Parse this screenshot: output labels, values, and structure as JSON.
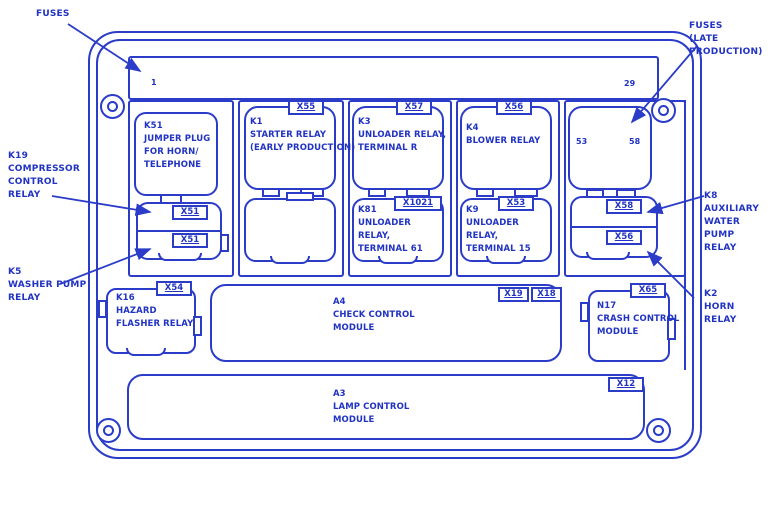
{
  "colors": {
    "line": "#2a3cc8",
    "text": "#2133c2",
    "background": "#ffffff"
  },
  "callouts": {
    "fuses": "FUSES",
    "fuses_late": "FUSES\n(LATE\nPRODUCTION)",
    "k19": "K19\nCOMPRESSOR\nCONTROL\nRELAY",
    "k5": "K5\nWASHER PUMP\nRELAY",
    "k8": "K8\nAUXILIARY\nWATER PUMP\nRELAY",
    "k2": "K2\nHORN RELAY"
  },
  "fuse_strip": {
    "first_fuse": "1",
    "last_fuse": "29"
  },
  "relays": {
    "k51": {
      "text": "K51\nJUMPER PLUG\nFOR HORN/\nTELEPHONE"
    },
    "k19_socket": {
      "connector": "X51"
    },
    "k5_socket": {
      "connector": "X51"
    },
    "k1": {
      "connector": "X55",
      "text": "K1\nSTARTER RELAY\n(EARLY PRODUCTION)"
    },
    "k3": {
      "connector": "X57",
      "text": "K3\nUNLOADER RELAY,\nTERMINAL R"
    },
    "k81": {
      "connector": "X1021",
      "text": "K81\nUNLOADER\nRELAY,\nTERMINAL 61"
    },
    "k4": {
      "connector": "X56",
      "text": "K4\nBLOWER RELAY"
    },
    "k9": {
      "connector": "X53",
      "text": "K9\nUNLOADER\nRELAY,\nTERMINAL 15"
    },
    "late_fuses": {
      "left": "53",
      "right": "58"
    },
    "k8_socket": {
      "connector": "X58"
    },
    "k2_socket": {
      "connector": "X56"
    }
  },
  "modules": {
    "k16": {
      "connector": "X54",
      "text": "K16\nHAZARD\nFLASHER RELAY"
    },
    "a4": {
      "connectors": [
        "X19",
        "X18"
      ],
      "text": "A4\nCHECK CONTROL\nMODULE"
    },
    "n17": {
      "connector": "X65",
      "text": "N17\nCRASH CONTROL\nMODULE"
    },
    "a3": {
      "connector": "X12",
      "text": "A3\nLAMP CONTROL\nMODULE"
    }
  }
}
